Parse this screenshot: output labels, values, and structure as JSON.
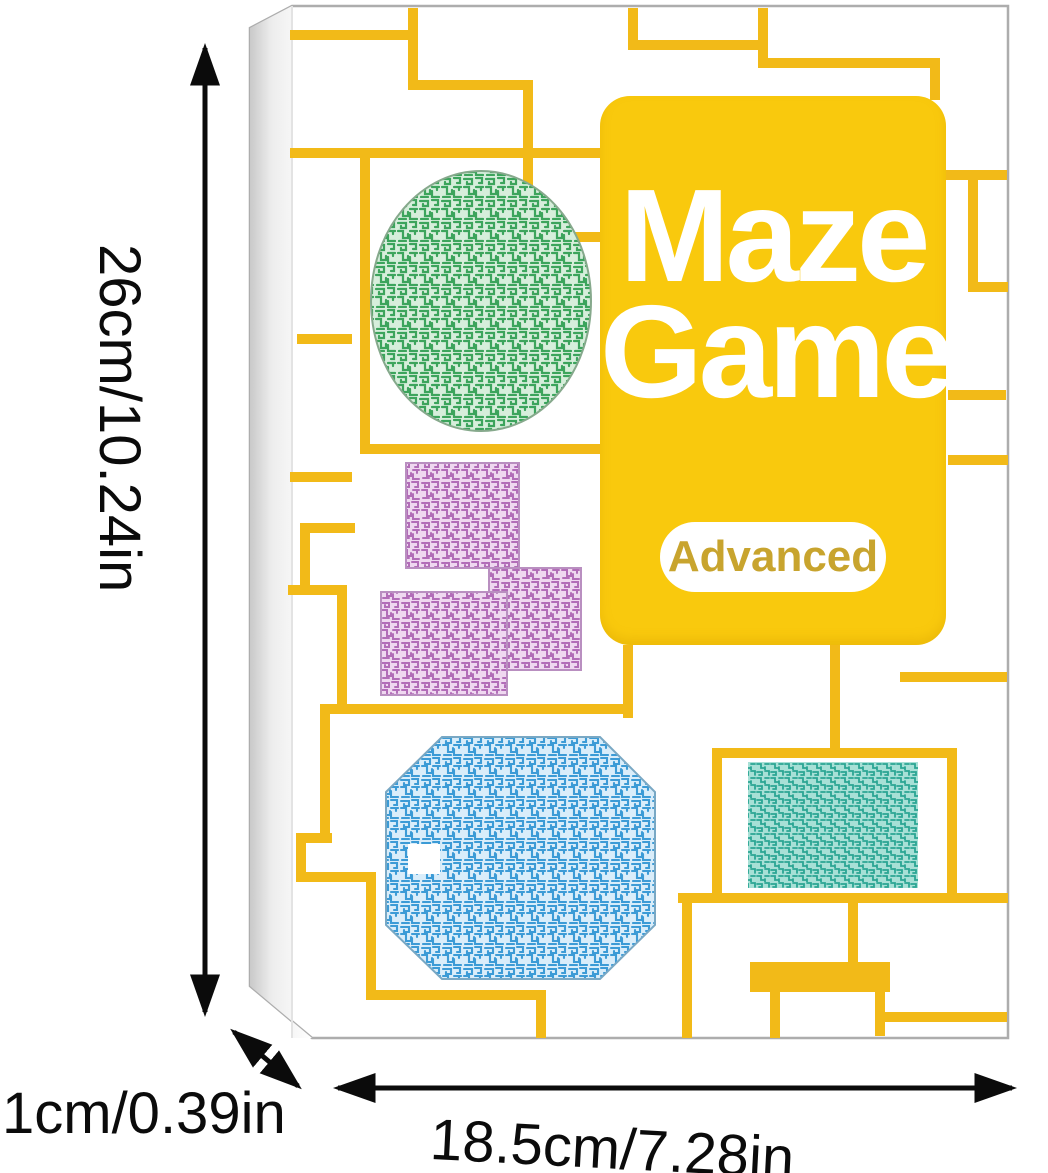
{
  "product": {
    "title_line1": "Maze",
    "title_line2": "Game",
    "badge": "Advanced"
  },
  "dimensions": {
    "height": "26cm/10.24in",
    "depth": "1cm/0.39in",
    "width": "18.5cm/7.28in"
  },
  "icons": {
    "height_arrow": "vertical-double-arrow",
    "width_arrow": "horizontal-double-arrow",
    "depth_arrow": "diagonal-double-arrow"
  },
  "colors": {
    "card_yellow": "#F9C90D",
    "maze_line_yellow": "#F2BA18",
    "maze_green": "#3CA45C",
    "maze_purple": "#B26DB8",
    "maze_blue": "#3C9BD6",
    "maze_teal": "#2AA593",
    "badge_text": "#C8A42E",
    "dimension_text": "#0B0B0B",
    "box_face": "#FFFFFF",
    "box_edge": "#ADADAD"
  }
}
